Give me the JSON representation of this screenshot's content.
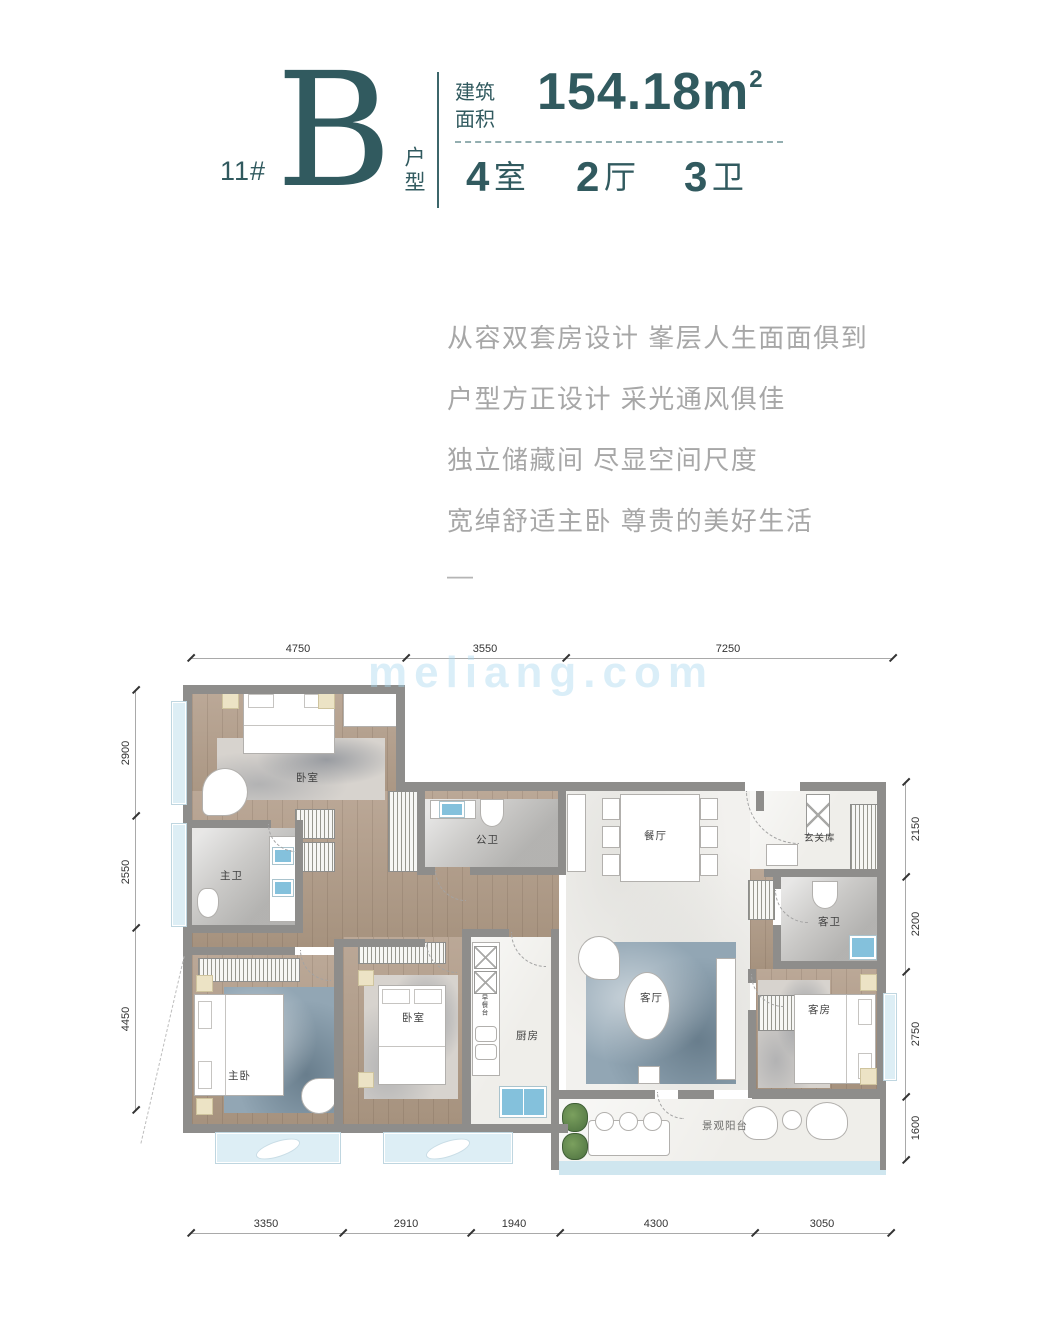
{
  "header": {
    "building_no": "11#",
    "type_letter": "B",
    "type_label": "户型",
    "area_label_line1": "建筑",
    "area_label_line2": "面积",
    "area_value": "154.18m",
    "area_sup": "2",
    "spec": [
      {
        "value": "4",
        "unit": "室"
      },
      {
        "value": "2",
        "unit": "厅"
      },
      {
        "value": "3",
        "unit": "卫"
      }
    ]
  },
  "description": {
    "lines": [
      "从容双套房设计 峯层人生面面俱到",
      "户型方正设计 采光通风俱佳",
      "独立储藏间 尽显空间尺度",
      "宽绰舒适主卧 尊贵的美好生活"
    ],
    "dash": "—"
  },
  "watermark": {
    "text": "meliang.com"
  },
  "rooms": {
    "bedroom_top": "卧室",
    "master_bath": "主卫",
    "public_bath": "公卫",
    "dining": "餐厅",
    "entry_storage": "玄关库",
    "master_bedroom": "主卧",
    "bedroom2": "卧室",
    "kitchen": "厨房",
    "kitchen_counter": "早餐台",
    "living": "客厅",
    "guest_bath": "客卫",
    "guest_room": "客房",
    "balcony": "景观阳台"
  },
  "dimensions": {
    "top": [
      "4750",
      "3550",
      "7250"
    ],
    "bottom": [
      "3350",
      "2910",
      "1940",
      "4300",
      "3050"
    ],
    "left": [
      "2900",
      "2550",
      "4450"
    ],
    "right": [
      "2150",
      "2200",
      "2750",
      "1600"
    ]
  },
  "colors": {
    "accent_teal": "#315a5f",
    "description_gray": "#a7a7a7",
    "wall_gray": "#8e8d8b",
    "wood_floor": "#b3a08e",
    "fixture_blue": "#84c1dc",
    "window_blue": "#ddeef5",
    "watermark_blue": "#a8d6ee"
  }
}
